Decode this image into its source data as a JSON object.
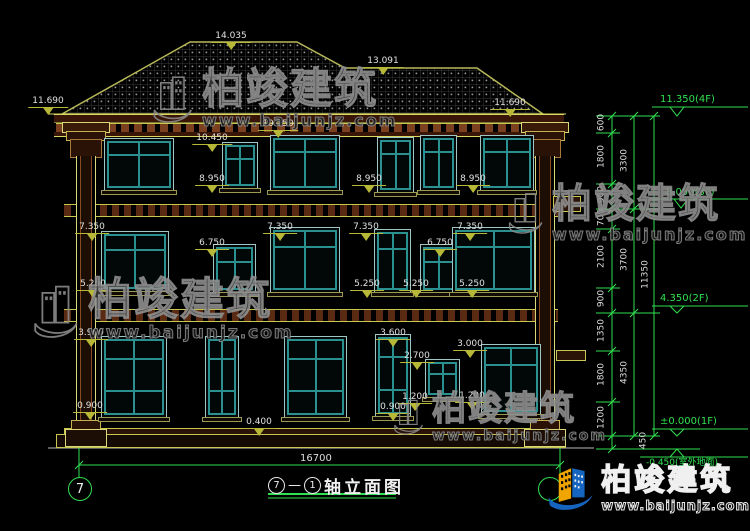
{
  "watermark": {
    "brand": "柏竣建筑",
    "url": "www.baijunjz.com"
  },
  "logo": {
    "brand": "柏竣建筑",
    "url": "www.baijunjz.com"
  },
  "facade_marks": [
    "14.035",
    "13.091",
    "11.690",
    "11.690",
    "10.450",
    "10.250",
    "8.950",
    "8.950",
    "8.950",
    "7.350",
    "7.350",
    "7.350",
    "7.350",
    "6.750",
    "6.750",
    "5.250",
    "5.250",
    "5.250",
    "5.250",
    "3.900",
    "3.600",
    "3.000",
    "2.700",
    "1.200",
    "1.200",
    "0.900",
    "0.900",
    "0.400"
  ],
  "chain": {
    "segments": [
      "600",
      "1800",
      "900",
      "700",
      "2100",
      "900",
      "1350",
      "1800",
      "1200"
    ],
    "subtotals": [
      "3300",
      "3700",
      "4350"
    ],
    "total": "11350",
    "below": "450",
    "marks": [
      "11.350(4F)",
      "8.050(3F)",
      "4.350(2F)",
      "±0.000(1F)",
      "-0.450(室外地面)"
    ]
  },
  "bottom": {
    "total_dim": "16700",
    "bubble_left": "7",
    "bubble_right": "",
    "title_axis_a": "7",
    "title_dash": "—",
    "title_axis_b": "1",
    "title_text": "轴立面图"
  }
}
